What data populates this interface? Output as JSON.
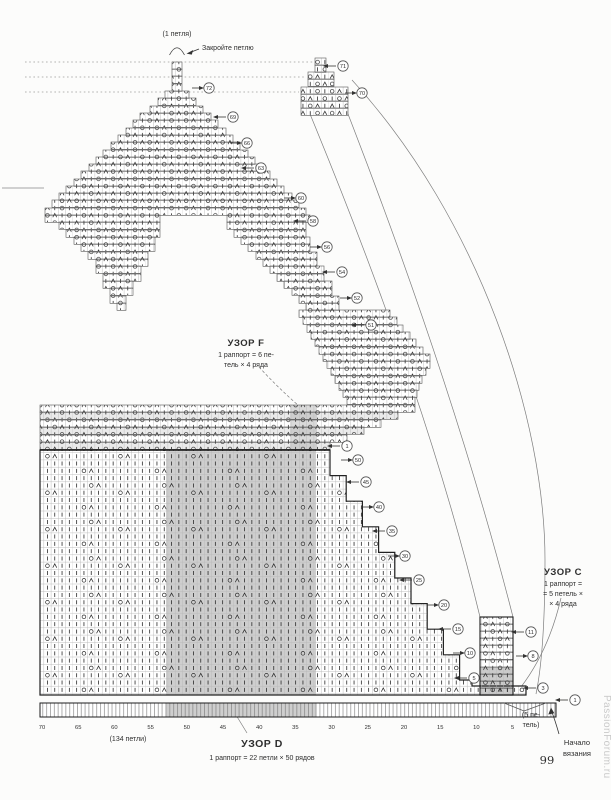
{
  "page": {
    "number": "99",
    "watermark": "PassionForum.ru"
  },
  "annotations": {
    "top_stitch": "(1 петля)",
    "bind_off": "Закройте петлю",
    "pattern_f": {
      "title": "УЗОР F",
      "line1": "1 раппорт = 6 пе-",
      "line2": "тель × 4 ряда"
    },
    "pattern_c": {
      "title": "УЗОР C",
      "line1": "1 раппорт =",
      "line2": "= 5 петель ×",
      "line3": "× 4 ряда"
    },
    "pattern_d": {
      "title": "УЗОР D",
      "line1": "1 раппорт = 22 петли × 50 рядов"
    },
    "cast_on": "(134 петли)",
    "five_sts_1": "(5 пе-",
    "five_sts_2": "тель)",
    "start_1": "Начало",
    "start_2": "вязания"
  },
  "axis": {
    "ticks": [
      "70",
      "65",
      "60",
      "55",
      "50",
      "45",
      "40",
      "35",
      "30",
      "25",
      "20",
      "15",
      "10",
      "5"
    ],
    "x0": 42,
    "dx": 36.2,
    "y": 729
  },
  "legend": {
    "symbols": {
      "O": "yarn-over",
      "Λ": "decrease",
      "|": "knit-stitch"
    }
  },
  "chart_data": {
    "type": "knitting-chart",
    "patterns": [
      {
        "name": "УЗОР F",
        "repeat": "1 раппорт = 6 петель × 4 ряда"
      },
      {
        "name": "УЗОР C",
        "repeat": "1 раппорт = 5 петель × 4 ряда"
      },
      {
        "name": "УЗОР D",
        "repeat": "1 раппорт = 22 петли × 50 рядов"
      }
    ],
    "cast_on_stitches": 134,
    "edge_stitches": 5,
    "start_note": "Начало вязания",
    "bind_off_note": "Закройте петлю",
    "top_note": "1 петля"
  },
  "markers": [
    {
      "n": "72",
      "d": "r",
      "x": 209,
      "y": 88
    },
    {
      "n": "69",
      "d": "l",
      "x": 233,
      "y": 117
    },
    {
      "n": "66",
      "d": "r",
      "x": 247,
      "y": 143
    },
    {
      "n": "63",
      "d": "l",
      "x": 261,
      "y": 168
    },
    {
      "n": "60",
      "d": "r",
      "x": 301,
      "y": 198
    },
    {
      "n": "58",
      "d": "l",
      "x": 313,
      "y": 221
    },
    {
      "n": "56",
      "d": "r",
      "x": 327,
      "y": 247
    },
    {
      "n": "54",
      "d": "l",
      "x": 342,
      "y": 272
    },
    {
      "n": "52",
      "d": "r",
      "x": 357,
      "y": 298
    },
    {
      "n": "51",
      "d": "l",
      "x": 371,
      "y": 325
    },
    {
      "n": "71",
      "d": "l",
      "x": 343,
      "y": 66
    },
    {
      "n": "70",
      "d": "r",
      "x": 362,
      "y": 93
    },
    {
      "n": "1",
      "d": "l",
      "x": 347,
      "y": 446
    },
    {
      "n": "50",
      "d": "r",
      "x": 358,
      "y": 460
    },
    {
      "n": "45",
      "d": "l",
      "x": 366,
      "y": 482
    },
    {
      "n": "40",
      "d": "r",
      "x": 379,
      "y": 507
    },
    {
      "n": "35",
      "d": "l",
      "x": 392,
      "y": 531
    },
    {
      "n": "30",
      "d": "r",
      "x": 405,
      "y": 556
    },
    {
      "n": "25",
      "d": "l",
      "x": 419,
      "y": 580
    },
    {
      "n": "20",
      "d": "r",
      "x": 444,
      "y": 605
    },
    {
      "n": "15",
      "d": "l",
      "x": 458,
      "y": 629
    },
    {
      "n": "10",
      "d": "r",
      "x": 470,
      "y": 653
    },
    {
      "n": "5",
      "d": "l",
      "x": 474,
      "y": 678
    },
    {
      "n": "11",
      "d": "l",
      "x": 531,
      "y": 632
    },
    {
      "n": "8",
      "d": "r",
      "x": 533,
      "y": 656
    },
    {
      "n": "3",
      "d": "l",
      "x": 543,
      "y": 688
    },
    {
      "n": "1",
      "d": "l",
      "x": 575,
      "y": 700
    }
  ],
  "geometry": {
    "cell": 7.3,
    "lace_rows": [
      [
        62,
        172,
        182
      ],
      [
        69,
        172,
        182
      ],
      [
        76,
        172,
        182
      ],
      [
        84,
        172,
        182
      ],
      [
        91,
        165,
        189
      ],
      [
        98,
        158,
        196
      ],
      [
        106,
        150,
        203
      ],
      [
        113,
        140,
        211
      ],
      [
        120,
        133,
        218
      ],
      [
        128,
        126,
        226
      ],
      [
        135,
        118,
        233
      ],
      [
        142,
        111,
        240
      ],
      [
        150,
        103,
        248
      ],
      [
        157,
        96,
        255
      ],
      [
        164,
        89,
        262
      ],
      [
        171,
        81,
        270
      ],
      [
        179,
        74,
        277
      ],
      [
        186,
        66,
        284
      ],
      [
        193,
        59,
        292
      ],
      [
        200,
        52,
        299
      ],
      [
        208,
        45,
        306
      ],
      [
        215,
        45,
        160,
        227,
        310
      ],
      [
        222,
        59,
        160,
        227,
        306
      ],
      [
        230,
        66,
        160,
        234,
        306
      ],
      [
        237,
        74,
        155,
        241,
        310
      ],
      [
        244,
        81,
        155,
        248,
        310
      ],
      [
        252,
        88,
        148,
        256,
        317
      ],
      [
        259,
        96,
        148,
        263,
        317
      ],
      [
        266,
        96,
        141,
        270,
        324
      ],
      [
        274,
        103,
        141,
        277,
        324
      ],
      [
        281,
        103,
        133,
        284,
        332
      ],
      [
        288,
        110,
        133,
        292,
        332
      ],
      [
        296,
        110,
        126,
        299,
        339
      ],
      [
        303,
        117,
        126,
        306,
        339
      ],
      [
        310,
        299,
        390
      ],
      [
        317,
        303,
        397
      ],
      [
        325,
        307,
        403
      ],
      [
        332,
        311,
        410
      ],
      [
        339,
        315,
        416
      ],
      [
        347,
        319,
        423
      ],
      [
        354,
        323,
        430
      ],
      [
        361,
        327,
        430
      ],
      [
        368,
        331,
        426
      ],
      [
        376,
        335,
        422
      ],
      [
        383,
        339,
        419
      ],
      [
        390,
        343,
        417
      ],
      [
        397,
        347,
        415
      ],
      [
        58,
        315,
        326
      ],
      [
        65,
        315,
        326
      ],
      [
        72,
        308,
        334
      ],
      [
        79,
        308,
        334
      ],
      [
        87,
        301,
        348
      ],
      [
        94,
        301,
        348
      ],
      [
        101,
        301,
        348
      ],
      [
        108,
        301,
        348
      ],
      [
        405,
        40,
        415
      ],
      [
        412,
        40,
        398
      ],
      [
        420,
        40,
        381
      ],
      [
        427,
        40,
        364
      ],
      [
        435,
        40,
        347
      ],
      [
        442,
        40,
        330
      ]
    ],
    "strip_rows": [
      [
        617,
        480,
        513
      ],
      [
        624,
        480,
        513
      ],
      [
        631,
        480,
        513
      ],
      [
        638,
        480,
        513
      ],
      [
        645,
        480,
        513
      ],
      [
        652,
        480,
        513
      ],
      [
        660,
        480,
        513
      ],
      [
        667,
        480,
        513
      ],
      [
        674,
        480,
        513
      ],
      [
        681,
        480,
        513
      ],
      [
        688,
        480,
        513
      ]
    ],
    "stripe_rows": [
      [
        412,
        40,
        398
      ],
      [
        427,
        40,
        364
      ],
      [
        442,
        40,
        330
      ]
    ],
    "gray_rects": [
      [
        166,
        450,
        150,
        245,
        0.5
      ],
      [
        290,
        405,
        27,
        44,
        0.38
      ],
      [
        166,
        703,
        150,
        14,
        0.5
      ],
      [
        480,
        668,
        33,
        27,
        0.55
      ]
    ],
    "body_path": "M40,450 H330 V475.6 H346.2 V501.2 H362.4 V526.8 H378.6 V552.4 H394.8 V578 H411 V603.6 H427.2 V629.2 H443.4 V654.8 H459.6 V680 H472 V686 H526 V695 H40 Z",
    "ruler": {
      "x": 40,
      "y": 703,
      "w": 516,
      "h": 14
    }
  }
}
